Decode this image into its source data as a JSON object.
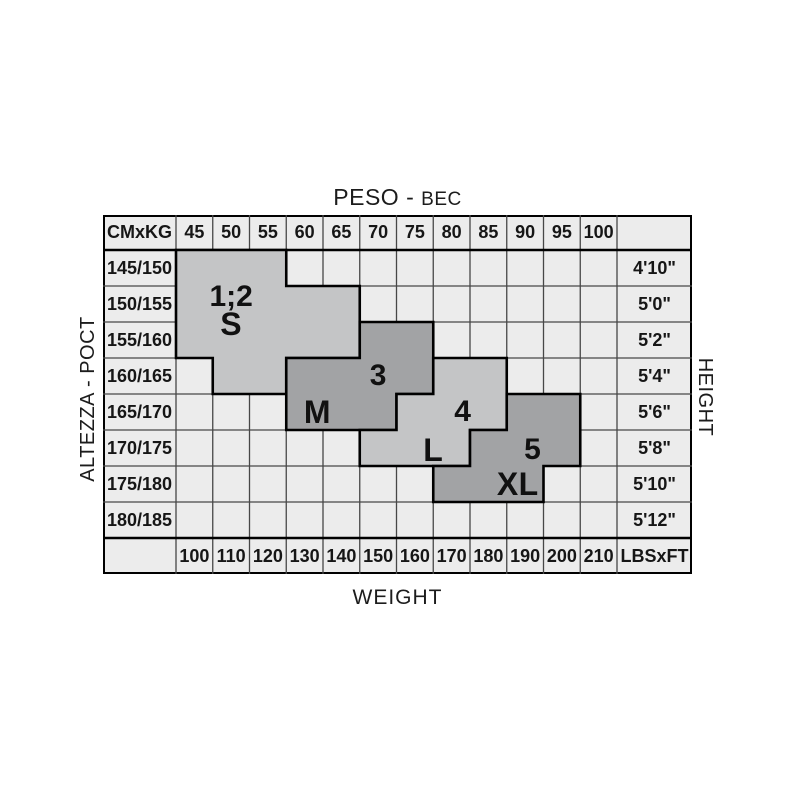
{
  "title": {
    "primary": "PESO - ",
    "secondary": "BEC"
  },
  "axes": {
    "left": "ALTEZZA - POCT",
    "right": "HEIGHT",
    "bottom": "WEIGHT"
  },
  "table": {
    "corner_top": "CMxKG",
    "corner_bottom": "LBSxFT",
    "kg": [
      "45",
      "50",
      "55",
      "60",
      "65",
      "70",
      "75",
      "80",
      "85",
      "90",
      "95",
      "100"
    ],
    "cm": [
      "145/150",
      "150/155",
      "155/160",
      "160/165",
      "165/170",
      "170/175",
      "175/180",
      "180/185"
    ],
    "ft": [
      "4'10\"",
      "5'0\"",
      "5'2\"",
      "5'4\"",
      "5'6\"",
      "5'8\"",
      "5'10\"",
      "5'12\""
    ],
    "lbs": [
      "100",
      "110",
      "120",
      "130",
      "140",
      "150",
      "160",
      "170",
      "180",
      "190",
      "200",
      "210"
    ]
  },
  "regions": [
    {
      "id": "s",
      "size_label": "S",
      "number_label": "1;2",
      "shade": "light",
      "rows": [
        [
          1,
          1,
          3
        ],
        [
          2,
          1,
          5
        ],
        [
          3,
          1,
          5
        ],
        [
          4,
          2,
          3
        ]
      ],
      "labels": [
        {
          "text": "1;2",
          "col": 2,
          "row": 1.8,
          "kind": "num"
        },
        {
          "text": "S",
          "col": 2,
          "row": 2.55,
          "kind": "letter"
        }
      ]
    },
    {
      "id": "m",
      "size_label": "M",
      "number_label": "3",
      "shade": "dark",
      "rows": [
        [
          3,
          6,
          7
        ],
        [
          4,
          4,
          7
        ],
        [
          5,
          4,
          6
        ]
      ],
      "labels": [
        {
          "text": "3",
          "col": 6,
          "row": 4,
          "kind": "num"
        },
        {
          "text": "M",
          "col": 4.35,
          "row": 5,
          "kind": "letter"
        }
      ]
    },
    {
      "id": "l",
      "size_label": "L",
      "number_label": "4",
      "shade": "light",
      "rows": [
        [
          4,
          8,
          9
        ],
        [
          5,
          7,
          9
        ],
        [
          6,
          6,
          8
        ]
      ],
      "labels": [
        {
          "text": "4",
          "col": 8.3,
          "row": 5,
          "kind": "num"
        },
        {
          "text": "L",
          "col": 7.5,
          "row": 6.05,
          "kind": "letter"
        }
      ]
    },
    {
      "id": "xl",
      "size_label": "XL",
      "number_label": "5",
      "shade": "dark",
      "rows": [
        [
          5,
          10,
          11
        ],
        [
          6,
          9,
          11
        ],
        [
          7,
          8,
          10
        ]
      ],
      "labels": [
        {
          "text": "5",
          "col": 10.2,
          "row": 6.05,
          "kind": "num"
        },
        {
          "text": "XL",
          "col": 9.8,
          "row": 7,
          "kind": "letter"
        }
      ]
    }
  ],
  "colors": {
    "region_light": "#c4c5c6",
    "region_dark": "#a2a3a5",
    "cell_bg": "#ececec",
    "grid_line": "#474747",
    "border": "#000000",
    "text": "#141414"
  },
  "chart_data": {
    "type": "heatmap",
    "title": "PESO - BEC (weight) vs ALTEZZA - POCT (height) size chart",
    "x_kg": [
      45,
      50,
      55,
      60,
      65,
      70,
      75,
      80,
      85,
      90,
      95,
      100
    ],
    "x_lbs": [
      100,
      110,
      120,
      130,
      140,
      150,
      160,
      170,
      180,
      190,
      200,
      210
    ],
    "y_cm": [
      "145/150",
      "150/155",
      "155/160",
      "160/165",
      "165/170",
      "170/175",
      "175/180",
      "180/185"
    ],
    "y_ft": [
      "4'10\"",
      "5'0\"",
      "5'2\"",
      "5'4\"",
      "5'6\"",
      "5'8\"",
      "5'10\"",
      "5'12\""
    ],
    "sizes": [
      {
        "size": "1;2 / S",
        "kg_range_by_height": {
          "145/150": [
            45,
            55
          ],
          "150/155": [
            45,
            65
          ],
          "155/160": [
            45,
            65
          ],
          "160/165": [
            50,
            55
          ]
        }
      },
      {
        "size": "3 / M",
        "kg_range_by_height": {
          "155/160": [
            70,
            75
          ],
          "160/165": [
            60,
            75
          ],
          "165/170": [
            60,
            70
          ]
        }
      },
      {
        "size": "4 / L",
        "kg_range_by_height": {
          "160/165": [
            80,
            85
          ],
          "165/170": [
            75,
            85
          ],
          "170/175": [
            70,
            80
          ]
        }
      },
      {
        "size": "5 / XL",
        "kg_range_by_height": {
          "165/170": [
            90,
            95
          ],
          "170/175": [
            85,
            95
          ],
          "175/180": [
            80,
            90
          ]
        }
      }
    ]
  }
}
